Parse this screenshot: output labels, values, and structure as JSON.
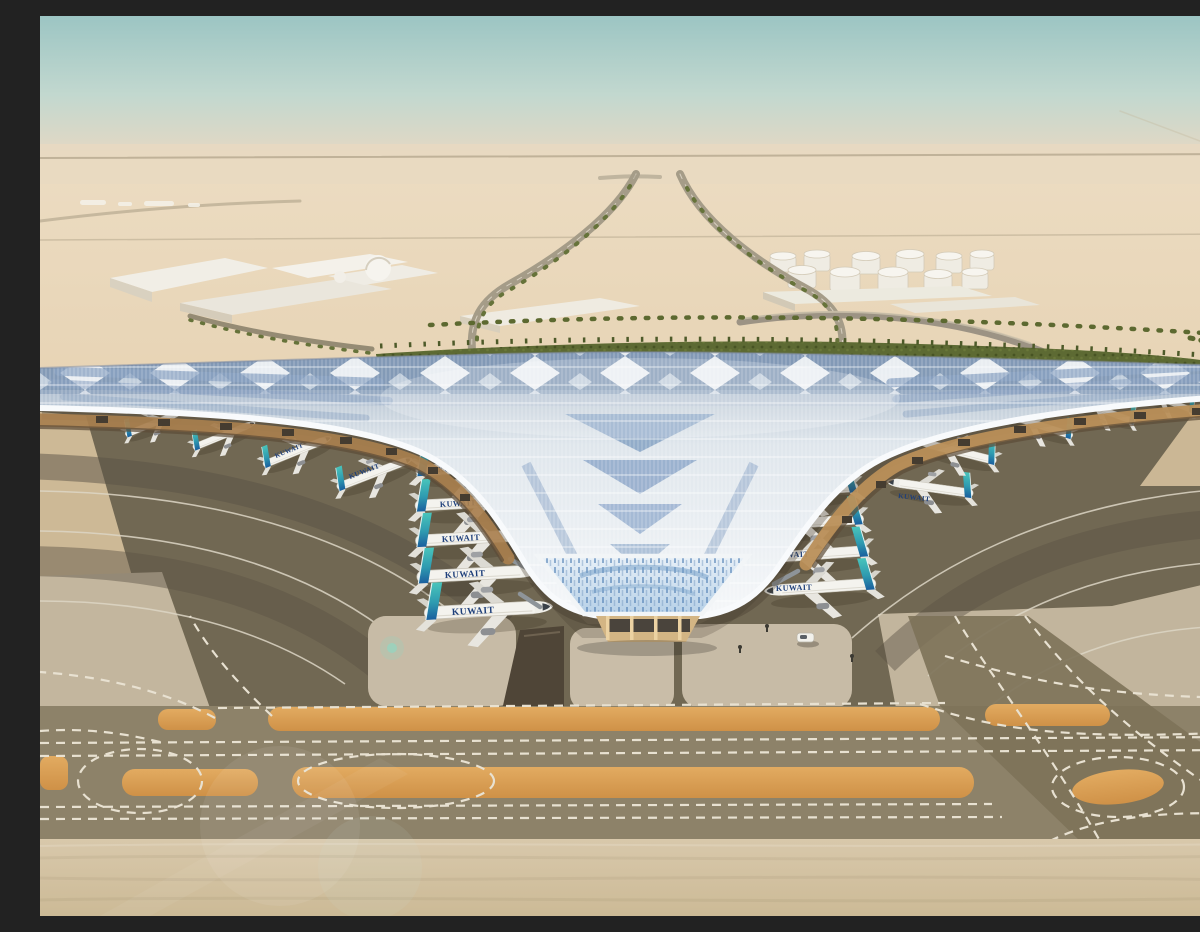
{
  "scene": {
    "description": "Aerial architectural rendering of a trident-shaped desert airport terminal (Kuwait International Airport T2 style): swooping silver roof with blue solar-panel diamonds, Kuwait Airways jets nose-in at both piers, palm-lined access roads, fuel tank farm, warehouses, and taxiways with orange shoulder strips in the sandy foreground.",
    "airline_livery_text": "KUWAIT",
    "counts": {
      "aircraft_visible": 21,
      "labeled_aircraft": 13,
      "fuel_tanks": 11,
      "aircraft_stand_pads": 3,
      "warehouse_buildings": 5
    },
    "colors": {
      "sky_top": "#a2c8c5",
      "sky_haze": "#e7d7c2",
      "desert_sand": "#e2cdab",
      "roof_silver": "#eef1f4",
      "roof_panel_blue": "#8aa5c5",
      "canopy_soffit_warm": "#a87f4e",
      "apron_asphalt": "#716853",
      "stand_concrete": "#c7bba6",
      "taxiway_grey": "#8d8269",
      "shoulder_orange": "#d99e52",
      "marking_white": "#e6dfcf",
      "aircraft_tail_teal": "#49c4bb",
      "aircraft_tail_blue": "#1a5f9e",
      "livery_navy": "#1e3f7a",
      "landscape_green": "#5d6a33"
    }
  }
}
